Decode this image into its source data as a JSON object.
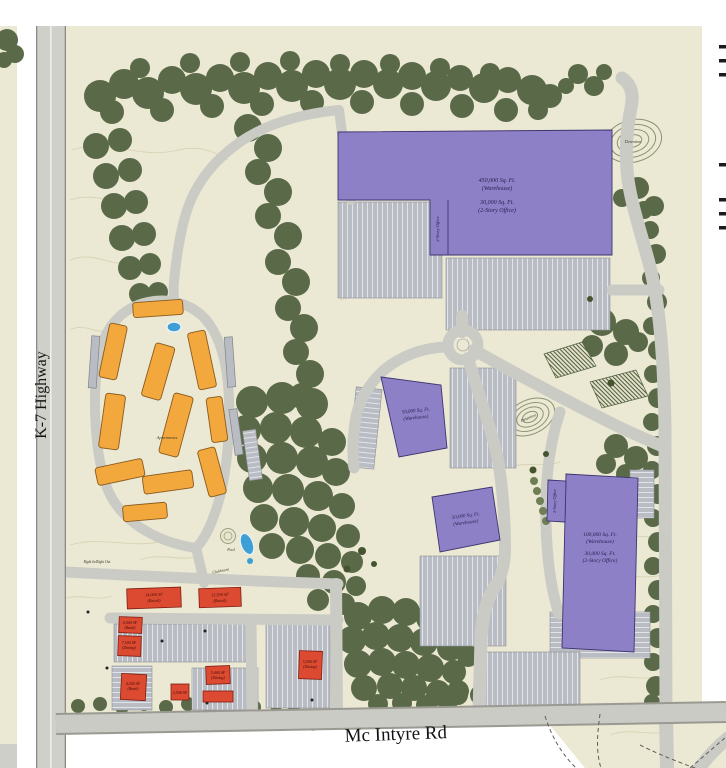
{
  "plan": {
    "roads": {
      "k7": "K-7 Highway",
      "mcintyre": "Mc Intyre Rd"
    },
    "buildings": {
      "b1": {
        "l1": "450,000 Sq. Ft.",
        "l2": "(Warehouse)",
        "l3": "30,000 Sq. Ft.",
        "l4": "(2-Story Office)",
        "wing": "2-Story Office"
      },
      "b2": {
        "l1": "50,000 Sq. Ft.",
        "l2": "(Warehouse)"
      },
      "b3": {
        "l1": "50,000 Sq. Ft.",
        "l2": "(Warehouse)"
      },
      "b4": {
        "l1": "100,000 Sq. Ft.",
        "l2": "(Warehouse)",
        "l3": "30,000 Sq. Ft.",
        "l4": "(2-Story Office)",
        "wing": "2-Story Office"
      },
      "apartments": "Apartments",
      "r1": {
        "l1": "14,000 SF",
        "l2": "(Retail)"
      },
      "r2": {
        "l1": "12,500 SF",
        "l2": "(Retail)"
      },
      "r3": {
        "l1": "4,000 SF",
        "l2": "(Bank)"
      },
      "r4": {
        "l1": "7,500 SF",
        "l2": "(Dining)"
      },
      "r5": {
        "l1": "4,500 SF",
        "l2": "(Bank)"
      },
      "r6": {
        "l1": "2,500 SF"
      },
      "r7": {
        "l1": "5,000 SF",
        "l2": "(Dining)"
      },
      "r9": {
        "l1": "5,500 SF",
        "l2": "(Dining)"
      }
    },
    "amenities": {
      "pool": "Pool",
      "clubhouse": "Clubhouse",
      "detention": "Detention",
      "access": "Right In/Right Out"
    },
    "colors": {
      "site_tan": "#ebe8d3",
      "tree_green": "#5a6a49",
      "road_gray": "#cbcbc6",
      "parking_gray": "#b9bdc3",
      "warehouse_purple": "#8e80c6",
      "apartment_orange": "#f3a83e",
      "retail_red": "#dd4a32",
      "pool_blue": "#3e9fd6"
    }
  }
}
